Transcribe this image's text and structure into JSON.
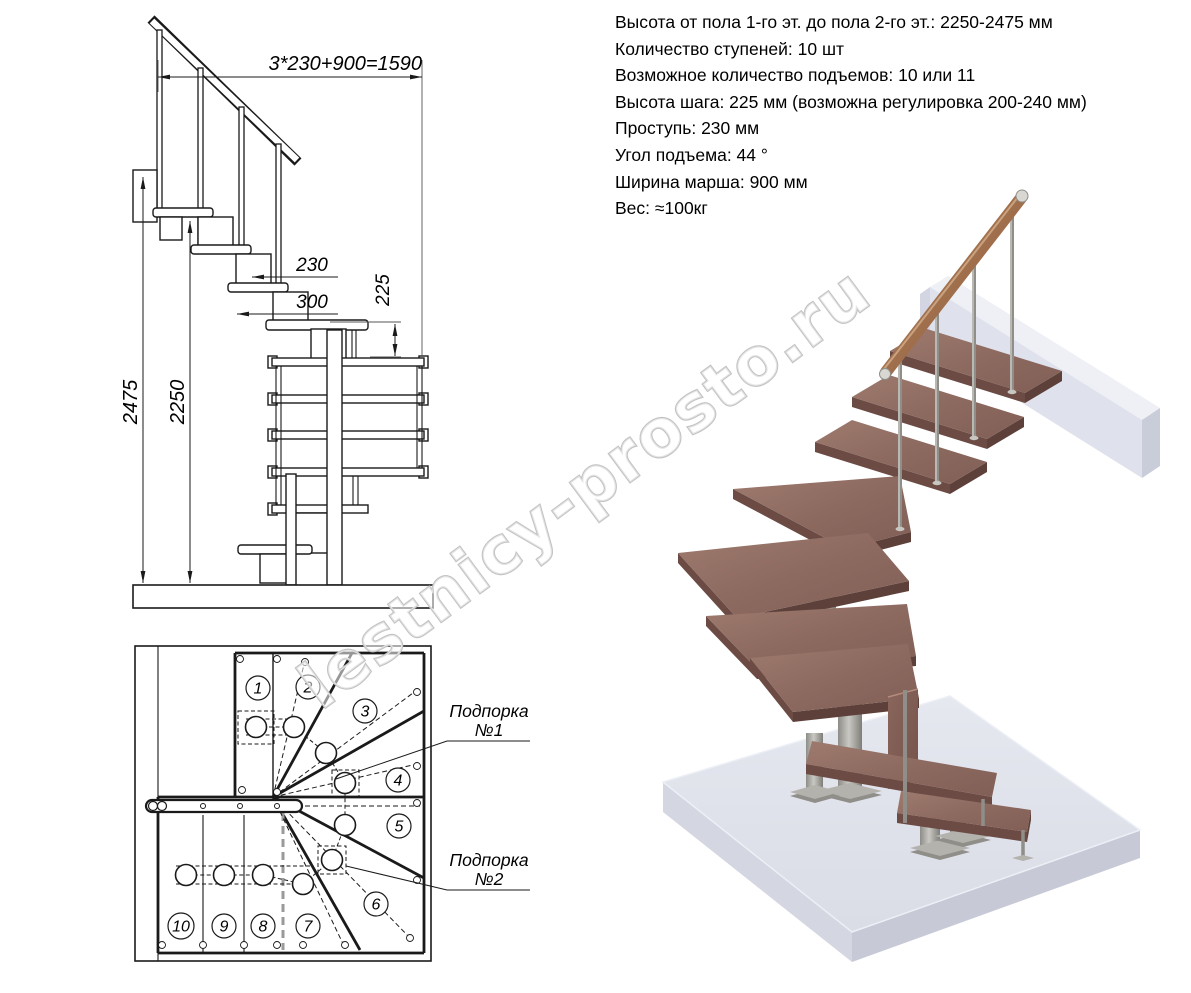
{
  "specs": {
    "lines": [
      "Высота от пола 1-го эт. до пола 2-го эт.: 2250-2475 мм",
      "Количество ступеней: 10 шт",
      "Возможное количество подъемов: 10 или 11",
      "Высота шага: 225 мм (возможна регулировка 200-240 мм)",
      "Проступь: 230 мм",
      "Угол подъема: 44 °",
      "Ширина марша: 900 мм",
      "Вес: ≈100кг"
    ]
  },
  "elevation": {
    "dim_run": "3*230+900=1590",
    "dim_tread_depth": "230",
    "dim_module_length": "300",
    "dim_step_height": "225",
    "dim_total_height": "2475",
    "dim_floor_height": "2250"
  },
  "plan": {
    "steps": [
      "1",
      "2",
      "3",
      "4",
      "5",
      "6",
      "7",
      "8",
      "9",
      "10"
    ],
    "support1": {
      "line1": "Подпорка",
      "line2": "№1"
    },
    "support2": {
      "line1": "Подпорка",
      "line2": "№2"
    }
  },
  "watermark": "lestnicy-prosto.ru",
  "colors": {
    "line": "#1a1a1a",
    "wood_light": "#9b766b",
    "wood_mid": "#8d6a60",
    "wood_dark": "#6b4b44",
    "rail_wood": "#a67752",
    "metal_light": "#c9c8c3",
    "metal_mid": "#a5a49f",
    "metal_dark": "#7e7d78",
    "floor_top": "#e2e4ed",
    "floor_left": "#d4d6e1",
    "floor_right": "#c7cad6",
    "block_face": "#dfe1ec",
    "block_top": "#eef0f6",
    "block_end": "#c9ccd9",
    "watermark_gray": "#c3c3c3"
  }
}
